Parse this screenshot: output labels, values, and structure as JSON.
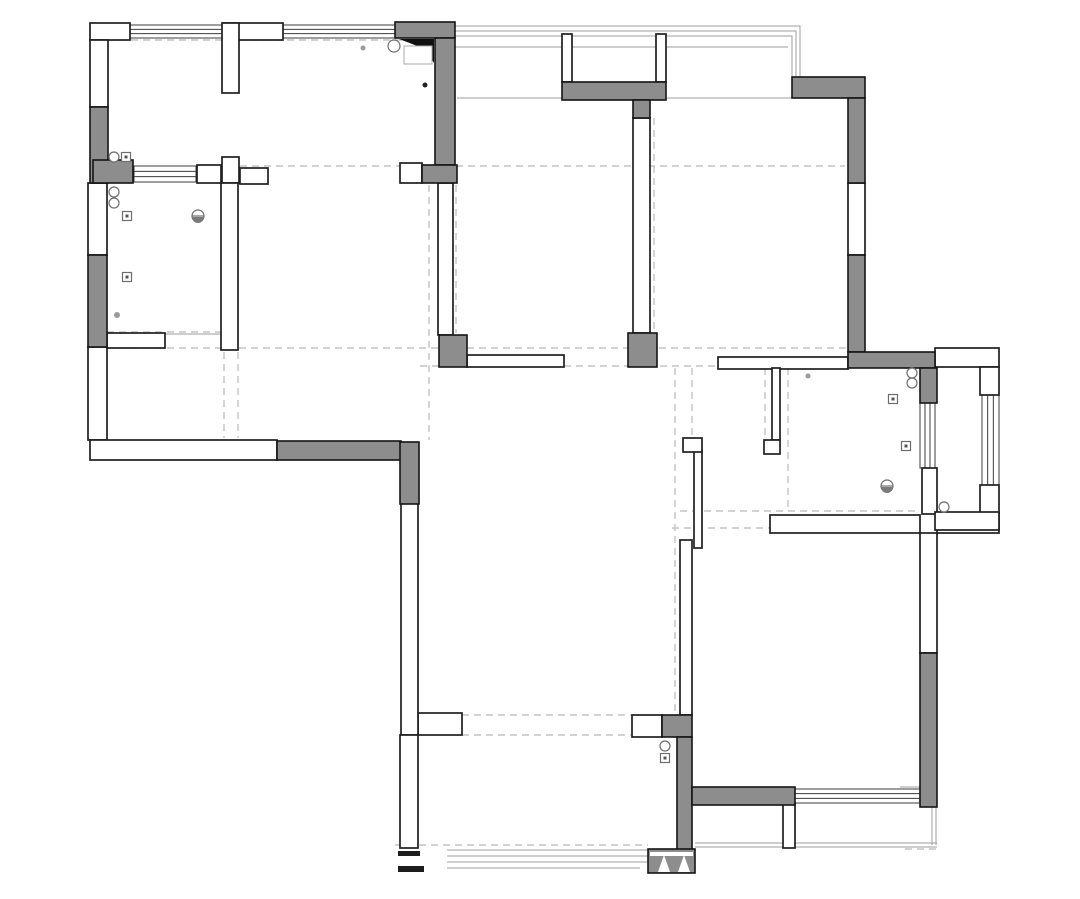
{
  "title": "apartment-floor-plan-drawing",
  "canvas": {
    "width": 1080,
    "height": 899,
    "background": "#ffffff"
  },
  "colors": {
    "wall_fill_gray": "#8d8d8d",
    "wall_stroke": "#1f1f1f",
    "thin_line": "#9d9d9d",
    "dashed_guide": "#c3c3c3",
    "symbol_stroke": "#6e6e6e"
  },
  "plan": {
    "eave_polylines": [
      [
        129,
        26,
        800,
        26,
        800,
        77
      ],
      [
        129,
        31,
        796,
        31,
        796,
        77
      ],
      [
        129,
        36,
        792,
        36,
        792,
        77
      ]
    ],
    "thin_lines": [
      [
        455,
        47,
        788,
        47
      ],
      [
        457,
        98,
        792,
        98
      ],
      [
        165,
        334,
        221,
        334
      ],
      [
        447,
        850,
        648,
        850
      ],
      [
        447,
        856,
        648,
        856
      ],
      [
        447,
        862,
        648,
        862
      ],
      [
        447,
        868,
        640,
        868
      ],
      [
        695,
        843,
        937,
        843
      ],
      [
        695,
        847,
        937,
        847
      ],
      [
        900,
        787,
        920,
        787
      ],
      [
        932,
        807,
        932,
        845
      ],
      [
        936,
        807,
        936,
        845
      ]
    ],
    "dashed_lines": [
      [
        107,
        40,
        430,
        40
      ],
      [
        240,
        166,
        845,
        166
      ],
      [
        107,
        332,
        238,
        332
      ],
      [
        107,
        348,
        846,
        348
      ],
      [
        420,
        366,
        762,
        366
      ],
      [
        224,
        352,
        224,
        438
      ],
      [
        238,
        352,
        238,
        438
      ],
      [
        429,
        185,
        429,
        440
      ],
      [
        456,
        185,
        456,
        333
      ],
      [
        654,
        118,
        654,
        333
      ],
      [
        462,
        715,
        632,
        715
      ],
      [
        462,
        735,
        632,
        735
      ],
      [
        675,
        368,
        675,
        712
      ],
      [
        692,
        368,
        692,
        438
      ],
      [
        788,
        368,
        788,
        511
      ],
      [
        680,
        511,
        918,
        511
      ],
      [
        672,
        528,
        770,
        528
      ],
      [
        765,
        368,
        765,
        438
      ],
      [
        395,
        845,
        648,
        845
      ],
      [
        905,
        849,
        940,
        849
      ]
    ],
    "windows": [
      {
        "x": 129,
        "y": 25,
        "w": 94,
        "h": 13,
        "dir": "h"
      },
      {
        "x": 283,
        "y": 25,
        "w": 112,
        "h": 13,
        "dir": "h"
      },
      {
        "x": 134,
        "y": 166,
        "w": 62,
        "h": 16,
        "dir": "h"
      },
      {
        "x": 920,
        "y": 403,
        "w": 15,
        "h": 65,
        "dir": "v"
      },
      {
        "x": 982,
        "y": 395,
        "w": 17,
        "h": 90,
        "dir": "v"
      },
      {
        "x": 795,
        "y": 789,
        "w": 125,
        "h": 14,
        "dir": "h"
      }
    ],
    "walls_white": [
      [
        90,
        23,
        40,
        17
      ],
      [
        223,
        23,
        60,
        17
      ],
      [
        90,
        40,
        18,
        67
      ],
      [
        88,
        183,
        19,
        72
      ],
      [
        88,
        347,
        19,
        93
      ],
      [
        90,
        440,
        187,
        20
      ],
      [
        222,
        23,
        17,
        70
      ],
      [
        222,
        157,
        17,
        26
      ],
      [
        221,
        183,
        17,
        167
      ],
      [
        197,
        165,
        24,
        18
      ],
      [
        107,
        333,
        58,
        15
      ],
      [
        240,
        168,
        28,
        16
      ],
      [
        400,
        163,
        22,
        20
      ],
      [
        438,
        183,
        15,
        152
      ],
      [
        633,
        118,
        17,
        215
      ],
      [
        467,
        355,
        97,
        12
      ],
      [
        562,
        34,
        10,
        48
      ],
      [
        656,
        34,
        10,
        48
      ],
      [
        848,
        183,
        17,
        72
      ],
      [
        718,
        357,
        130,
        12
      ],
      [
        772,
        368,
        8,
        72
      ],
      [
        764,
        440,
        16,
        14
      ],
      [
        694,
        450,
        8,
        98
      ],
      [
        683,
        438,
        19,
        14
      ],
      [
        680,
        540,
        12,
        175
      ],
      [
        770,
        515,
        150,
        18
      ],
      [
        937,
        513,
        62,
        20
      ],
      [
        922,
        468,
        15,
        46
      ],
      [
        920,
        533,
        17,
        120
      ],
      [
        935,
        348,
        64,
        19
      ],
      [
        980,
        367,
        19,
        28
      ],
      [
        980,
        485,
        19,
        28
      ],
      [
        935,
        512,
        64,
        18
      ],
      [
        418,
        713,
        44,
        22
      ],
      [
        401,
        503,
        17,
        232
      ],
      [
        400,
        735,
        18,
        113
      ],
      [
        632,
        715,
        30,
        22
      ],
      [
        783,
        803,
        12,
        45
      ]
    ],
    "walls_gray": [
      [
        395,
        22,
        60,
        16
      ],
      [
        435,
        38,
        20,
        127
      ],
      [
        422,
        165,
        35,
        18
      ],
      [
        90,
        107,
        18,
        76
      ],
      [
        93,
        160,
        40,
        23
      ],
      [
        88,
        255,
        19,
        92
      ],
      [
        277,
        441,
        124,
        19
      ],
      [
        400,
        442,
        19,
        62
      ],
      [
        562,
        82,
        104,
        18
      ],
      [
        633,
        100,
        17,
        18
      ],
      [
        628,
        333,
        29,
        34
      ],
      [
        439,
        335,
        28,
        32
      ],
      [
        792,
        77,
        73,
        21
      ],
      [
        848,
        98,
        17,
        85
      ],
      [
        848,
        255,
        17,
        97
      ],
      [
        848,
        352,
        87,
        16
      ],
      [
        920,
        368,
        17,
        35
      ],
      [
        662,
        715,
        30,
        22
      ],
      [
        677,
        737,
        15,
        113
      ],
      [
        692,
        787,
        103,
        18
      ],
      [
        920,
        653,
        17,
        154
      ],
      [
        648,
        849,
        47,
        24
      ]
    ],
    "black_stubs": [
      [
        398,
        851,
        22,
        5
      ],
      [
        398,
        866,
        26,
        6
      ]
    ],
    "corner_wedge": {
      "points": "399,39 434,39 434,63 425,49 407,42",
      "fill": "#111111"
    },
    "duct_box": {
      "x": 404,
      "y": 46,
      "w": 28,
      "h": 18
    },
    "entry_door": {
      "slot": [
        650,
        852,
        43,
        4
      ],
      "leaves": [
        "658,872 664,855 670,872",
        "678,872 684,855 690,872"
      ]
    },
    "symbols": {
      "circles": [
        [
          114,
          157,
          5
        ],
        [
          114,
          192,
          5
        ],
        [
          114,
          203,
          5
        ],
        [
          394,
          46,
          6
        ],
        [
          912,
          373,
          5
        ],
        [
          912,
          383,
          5
        ],
        [
          944,
          507,
          5
        ],
        [
          665,
          746,
          5
        ]
      ],
      "outlets": [
        [
          126,
          157
        ],
        [
          127,
          216
        ],
        [
          127,
          277
        ],
        [
          893,
          399
        ],
        [
          906,
          446
        ],
        [
          665,
          758
        ]
      ],
      "lamps": [
        [
          198,
          216
        ],
        [
          887,
          486
        ]
      ],
      "dots": [
        {
          "x": 363,
          "y": 48,
          "r": 2.5,
          "c": "#9a9a9a"
        },
        {
          "x": 425,
          "y": 85,
          "r": 2.5,
          "c": "#222222"
        },
        {
          "x": 808,
          "y": 376,
          "r": 2.5,
          "c": "#9a9a9a"
        },
        {
          "x": 117,
          "y": 315,
          "r": 3,
          "c": "#9a9a9a"
        }
      ]
    }
  }
}
